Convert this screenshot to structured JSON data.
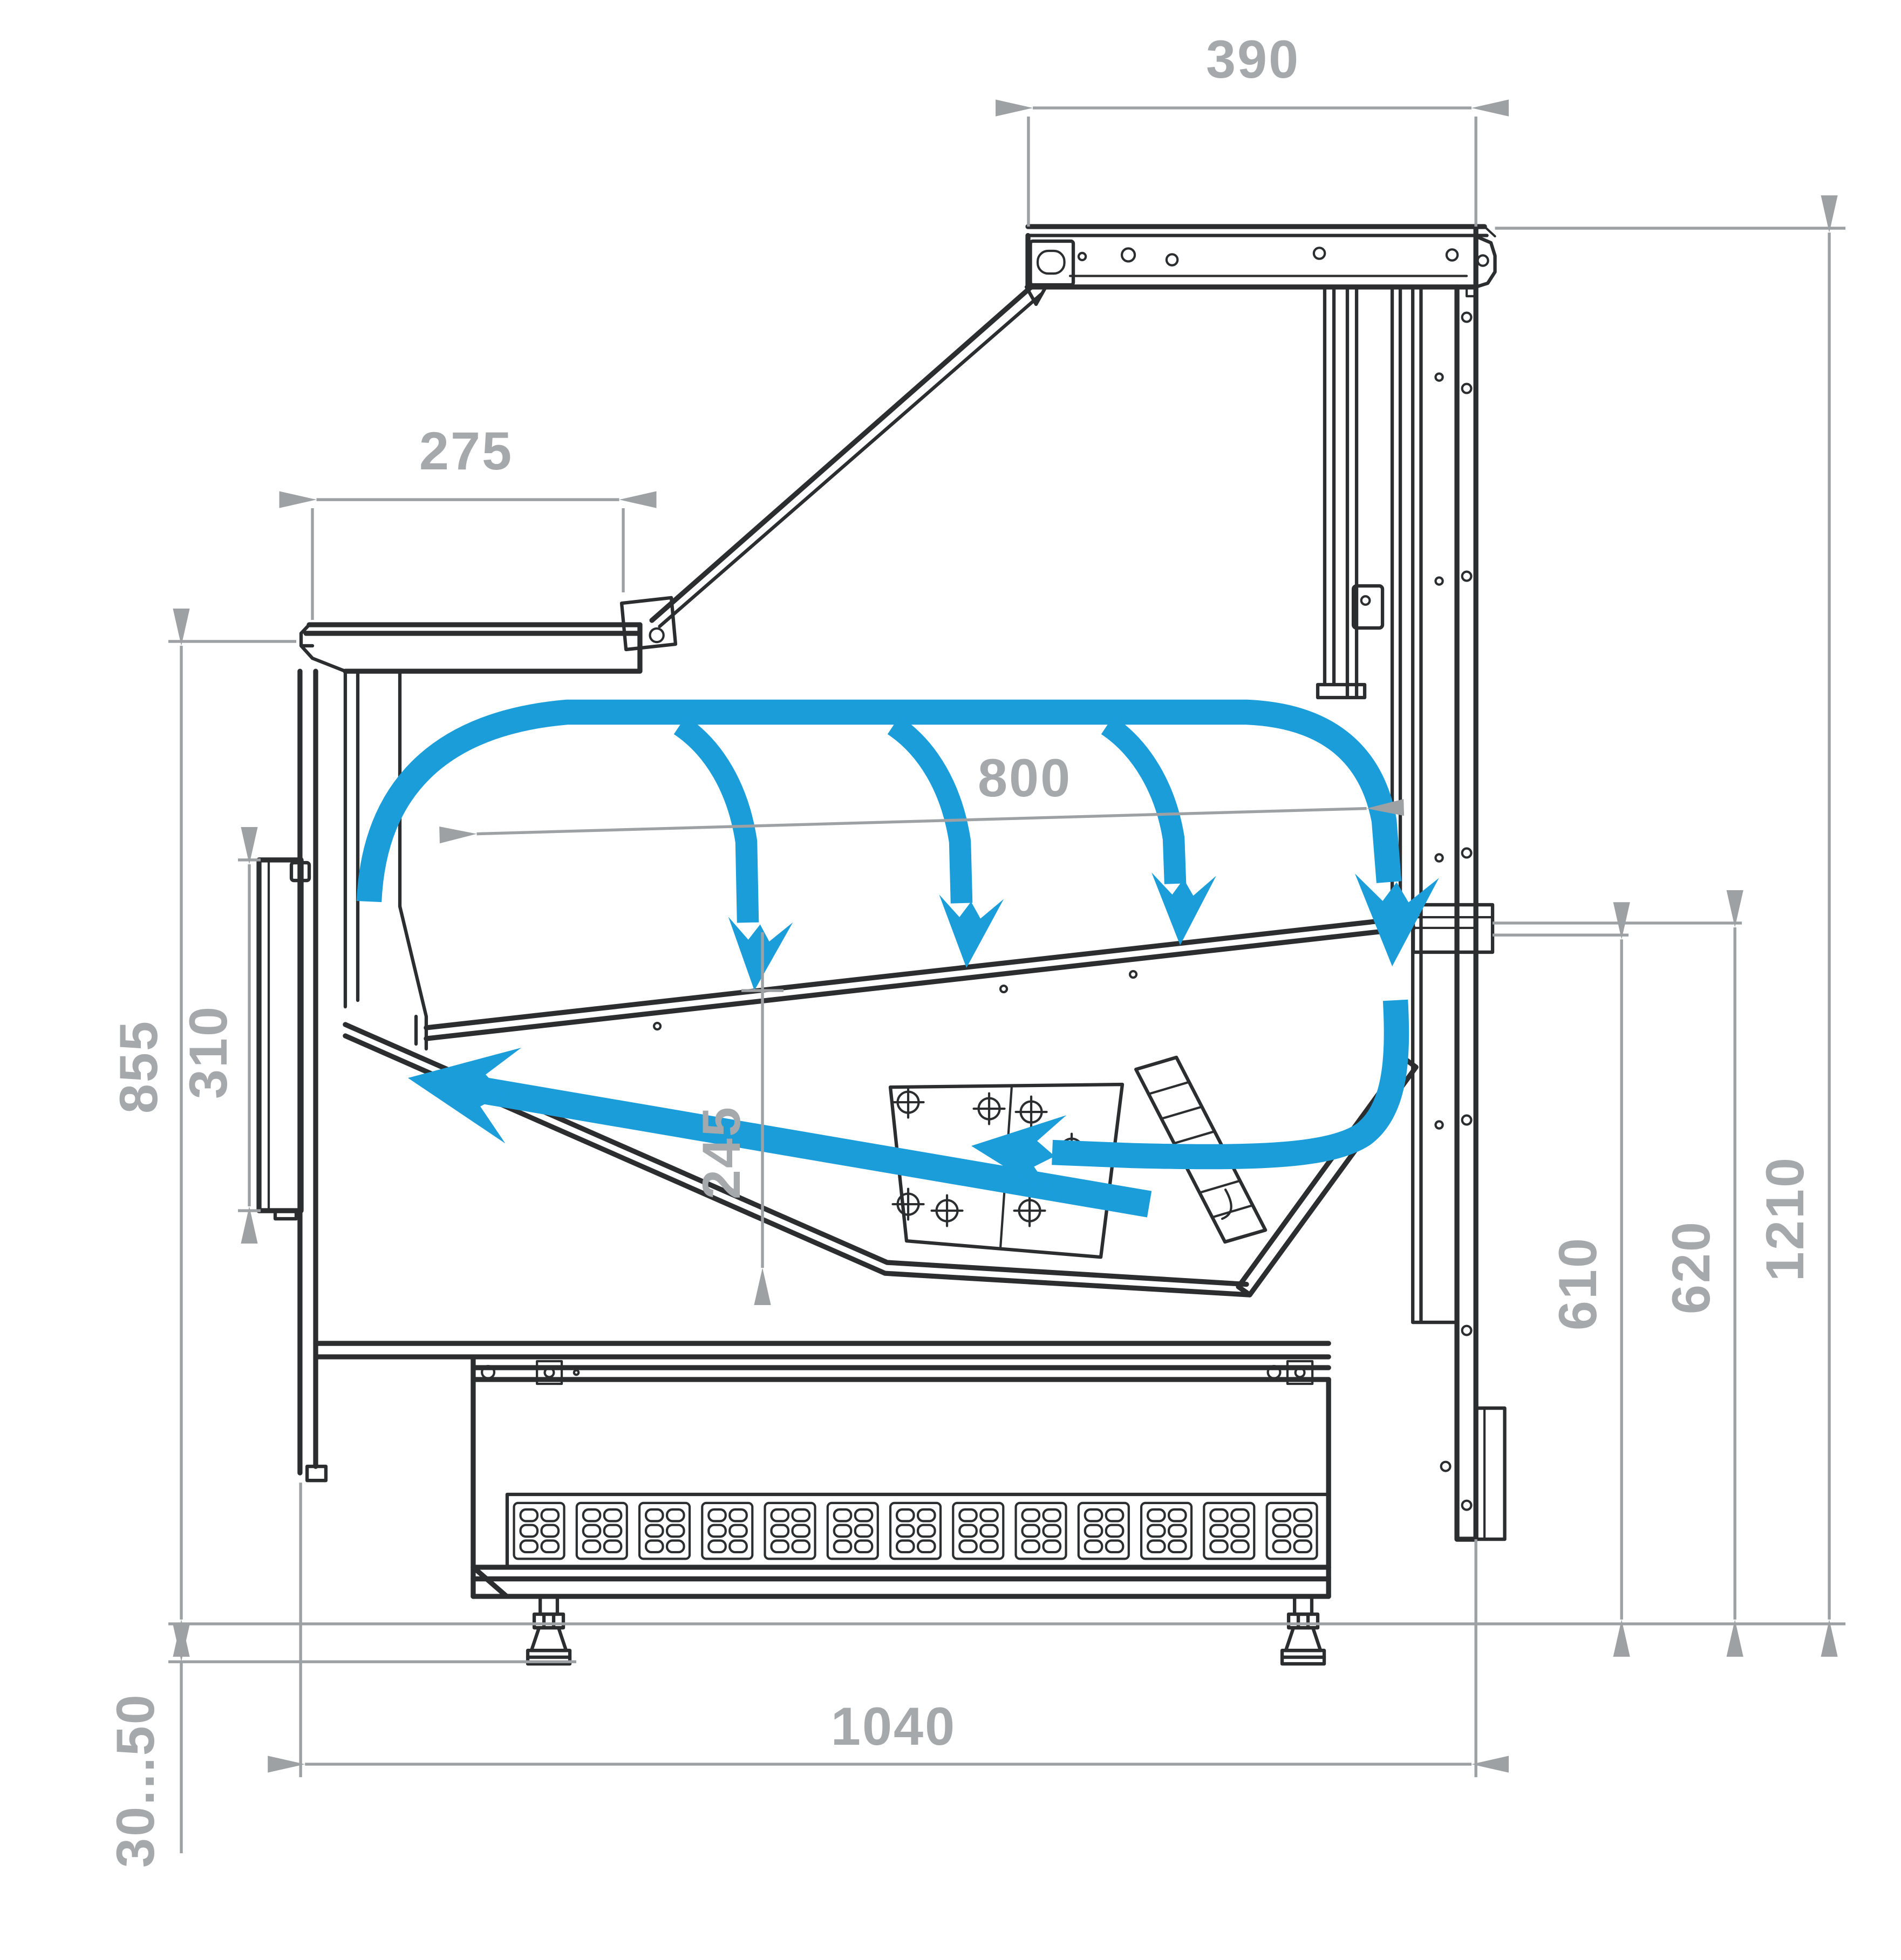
{
  "dims": {
    "top_canopy_depth": "390",
    "counter_top_depth": "275",
    "display_opening_width": "800",
    "front_height": "855",
    "front_panel_height": "310",
    "well_depth": "245",
    "rear_inner_height": "610",
    "rear_mid_height": "620",
    "overall_height": "1210",
    "base_depth": "1040",
    "foot_adjust_range": "30...50"
  },
  "colors": {
    "airflow": "#1b9dda",
    "outline": "#2b2d2f",
    "dimension": "#9da1a4",
    "dimension_text": "#a5a9ac",
    "background": "#ffffff"
  },
  "icons": {
    "airflow_arrows": "curved-airflow-arrow",
    "dimension_arrows": "dimension-arrowhead",
    "screw_marks": "crosshair-screw"
  }
}
